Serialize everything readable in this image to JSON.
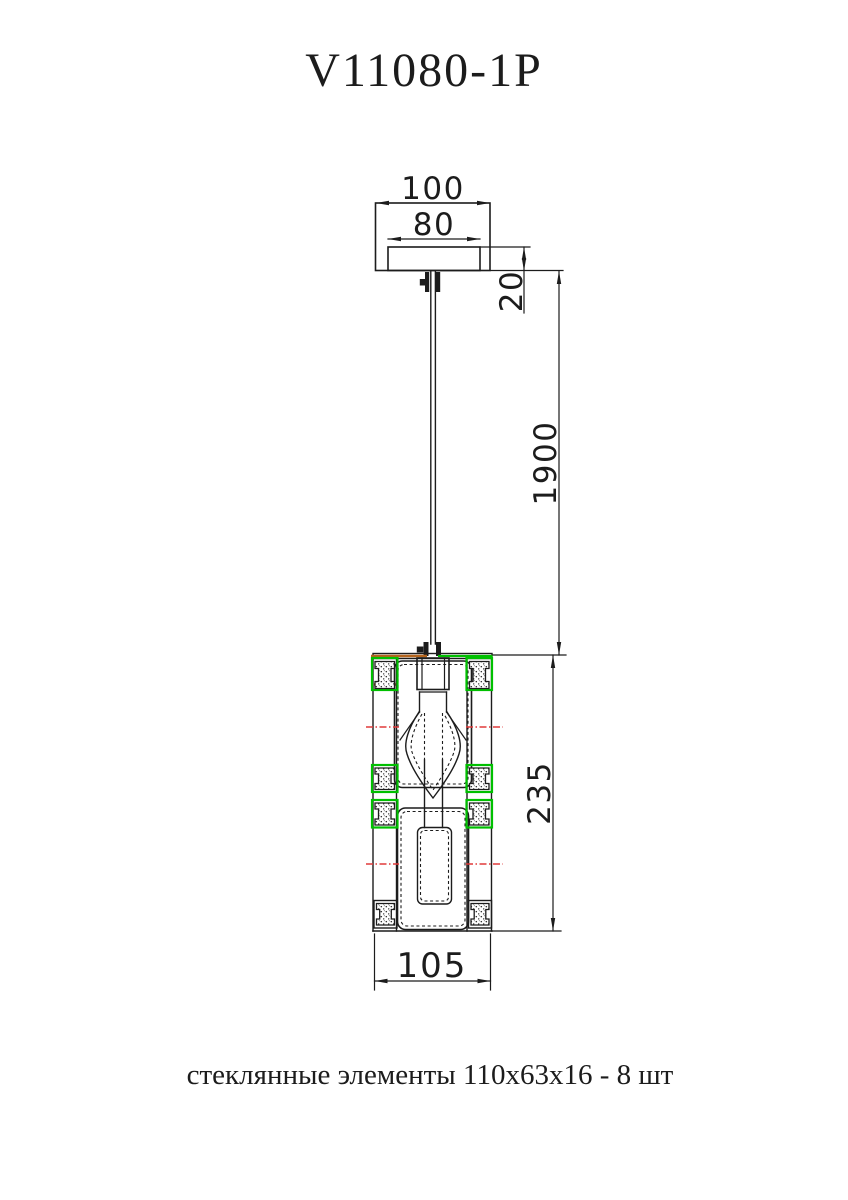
{
  "title": "V11080-1P",
  "caption": "стеклянные элементы 110x63x16 - 8 шт",
  "dimensions": {
    "canopy_outer_width": "100",
    "canopy_plate_width": "80",
    "canopy_plate_height": "20",
    "suspension_height": "1900",
    "shade_height": "235",
    "shade_width": "105"
  },
  "colors": {
    "line": "#1c1c1c",
    "glass_highlight": "#00c000",
    "centerline_red": "#e03a3a",
    "accent_orange": "#b5651d"
  }
}
